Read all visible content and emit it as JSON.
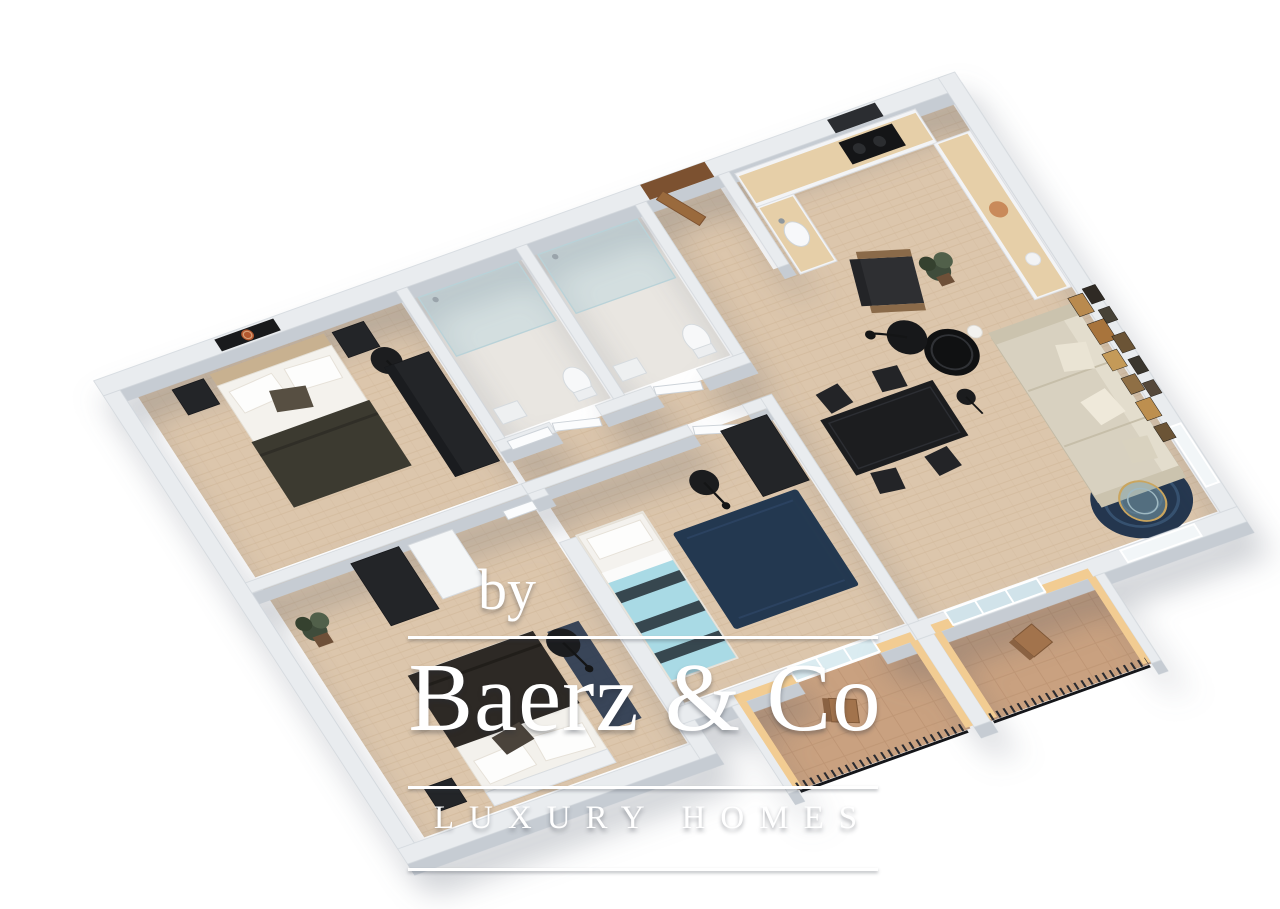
{
  "scene": {
    "description": "3D isometric floor plan rendering of an apartment",
    "palette": {
      "background": "#ffffff",
      "wall_top": "#e9ecef",
      "wall_face": "#c6ccd3",
      "wood_floor": "#dcc6ac",
      "bath_floor": "#e9e6e1",
      "balcony_floor": "#c9a180",
      "balcony_wall_yellow": "#f2cc92",
      "rug_navy": "#24364e",
      "dark_furniture": "#1d1e20",
      "sofa_beige": "#d8d1c0",
      "teal_bed": "#a9dae5",
      "front_door_wood": "#8a5a33",
      "art_accent_orange": "#b3572f",
      "watermark_text": "#ffffff"
    }
  },
  "watermark": {
    "prefix": "by",
    "brand": "Baerz & Co",
    "tagline": "LUXURY HOMES"
  }
}
